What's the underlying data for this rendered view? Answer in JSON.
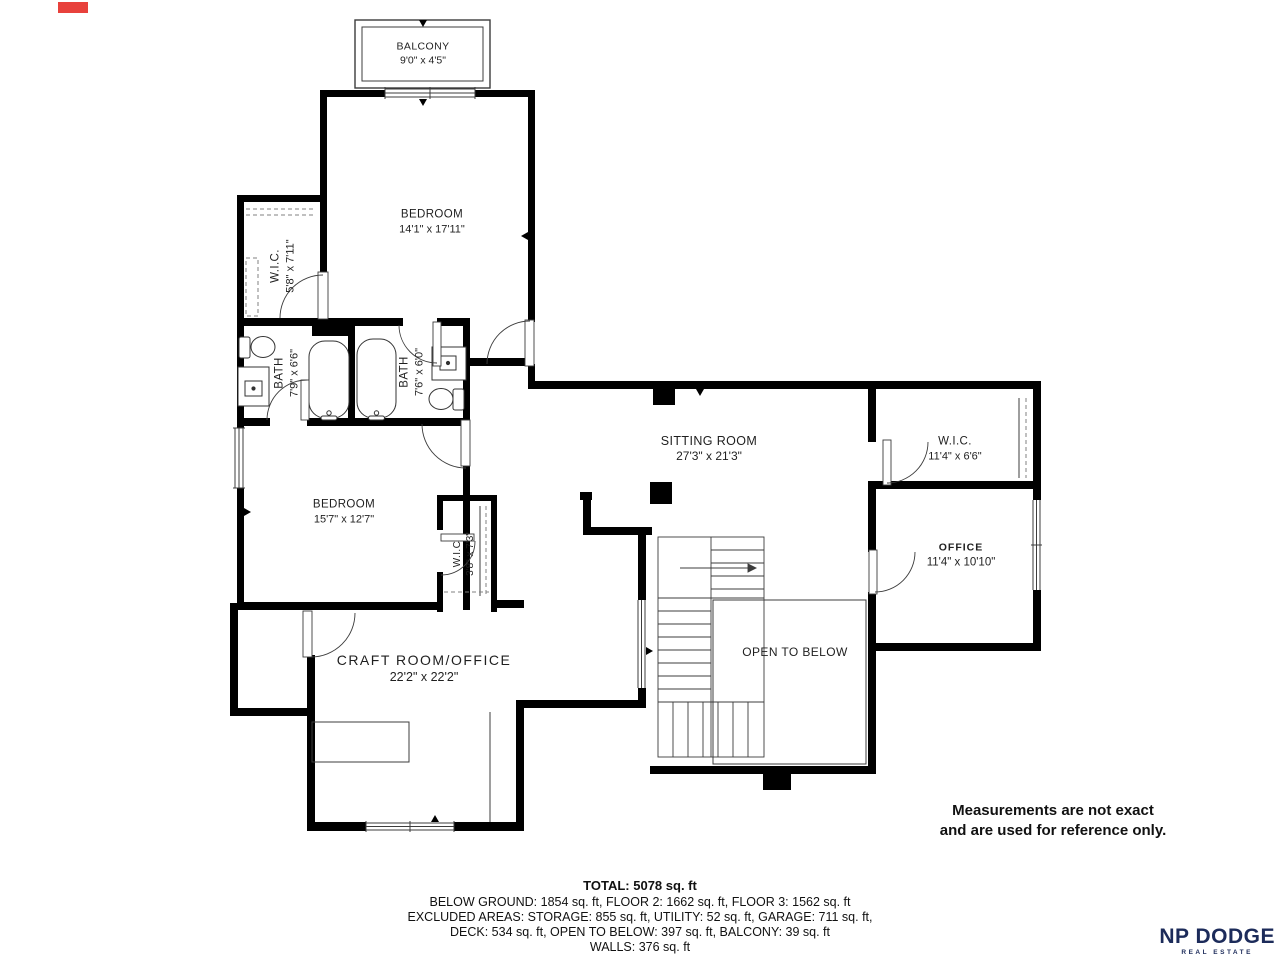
{
  "rooms": [
    {
      "name": "BALCONY",
      "dims": "9'0\" x 4'5\""
    },
    {
      "name": "BEDROOM",
      "dims": "14'1\" x 17'11\""
    },
    {
      "name": "W.I.C.",
      "dims": "5'8\" x 7'11\""
    },
    {
      "name": "BATH",
      "dims": "7'9\" x 6'6\""
    },
    {
      "name": "BATH",
      "dims": "7'6\" x 6'0\""
    },
    {
      "name": "SITTING ROOM",
      "dims": "27'3\" x 21'3\""
    },
    {
      "name": "W.I.C.",
      "dims": "11'4\" x 6'6\""
    },
    {
      "name": "BEDROOM",
      "dims": "15'7\" x 12'7\""
    },
    {
      "name": "W.I.C",
      "dims": "3'8\" x 7'3\""
    },
    {
      "name": "OFFICE",
      "dims": "11'4\" x 10'10\""
    },
    {
      "name": "CRAFT ROOM/OFFICE",
      "dims": "22'2\" x 22'2\""
    },
    {
      "name": "OPEN TO BELOW",
      "dims": ""
    }
  ],
  "disclaimer": {
    "line1": "Measurements are not exact",
    "line2": "and are used for reference only."
  },
  "summary": {
    "total": "TOTAL: 5078 sq. ft",
    "line2": "BELOW GROUND: 1854 sq. ft, FLOOR 2: 1662 sq. ft, FLOOR 3: 1562 sq. ft",
    "line3": "EXCLUDED AREAS: STORAGE: 855 sq. ft, UTILITY: 52 sq. ft, GARAGE: 711 sq. ft,",
    "line4": "DECK: 534 sq. ft, OPEN TO BELOW: 397 sq. ft, BALCONY: 39 sq. ft",
    "line5": "WALLS: 376 sq. ft"
  },
  "logo": {
    "brand": "NP DODGE",
    "sub": "REAL ESTATE"
  },
  "colors": {
    "wall": "#000000",
    "line": "#3c3c3c",
    "logo_navy": "#1c2b5a",
    "red_mark": "#e8413c"
  }
}
